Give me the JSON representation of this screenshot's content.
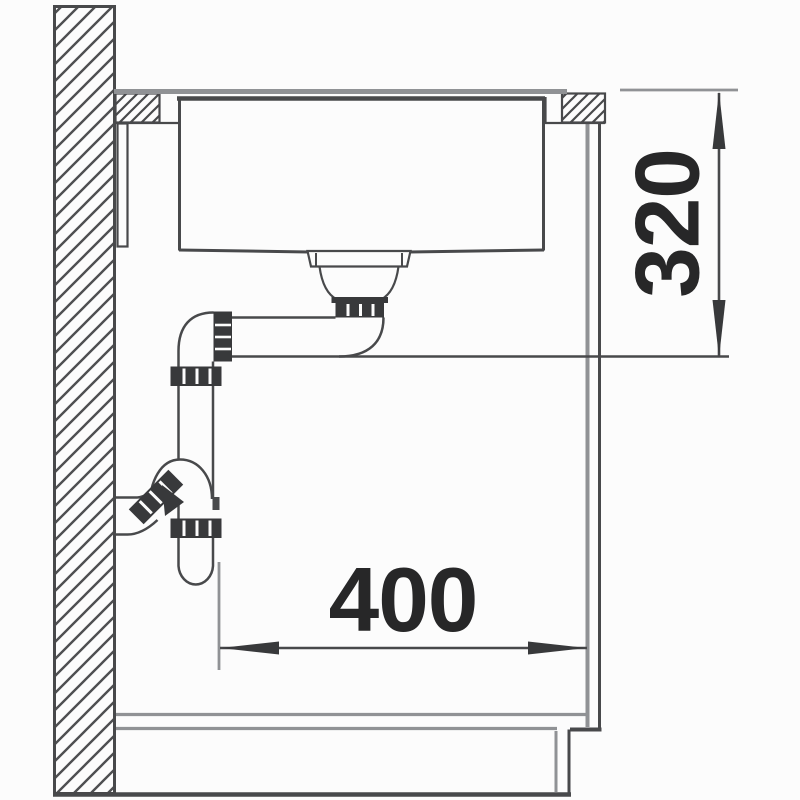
{
  "drawing": {
    "dimensions": {
      "vertical": "320",
      "horizontal": "400"
    },
    "colors": {
      "line_dark": "#48494b",
      "line_gray": "#909295",
      "fitting_fill": "#38393b",
      "text": "#272728",
      "background": "#fcfcfc"
    }
  }
}
